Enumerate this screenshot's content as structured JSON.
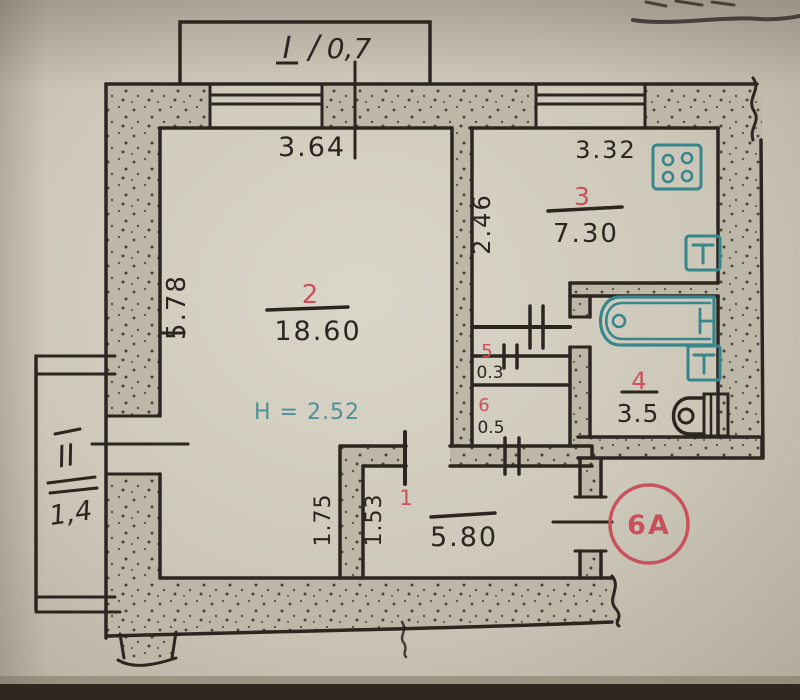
{
  "document": {
    "type": "scanned apartment floor plan",
    "entrance_stamp": "6A"
  },
  "plan": {
    "ceiling_height": "H = 2.52",
    "balcony_top": {
      "numeral": "I",
      "separator": "/",
      "area": "0,7"
    },
    "balcony_left": {
      "numeral": "II",
      "area": "1,4"
    },
    "rooms": [
      {
        "number": "1",
        "area": "5.80",
        "dims": [
          "1.75",
          "1.53"
        ]
      },
      {
        "number": "2",
        "area": "18.60",
        "dims": [
          "3.64",
          "5.78"
        ]
      },
      {
        "number": "3",
        "area": "7.30",
        "dims": [
          "3.32",
          "2.46"
        ]
      },
      {
        "number": "4",
        "area": "3.5",
        "dims": []
      },
      {
        "number": "5",
        "area": "0.3",
        "dims": []
      },
      {
        "number": "6",
        "area": "0.5",
        "dims": []
      }
    ]
  },
  "colors": {
    "ink": "#2b2620",
    "room_number_red": "#c8515b",
    "fixture_teal": "#37868b",
    "wall_fill": "#bdb7a8",
    "paper": "#cfcabb"
  }
}
